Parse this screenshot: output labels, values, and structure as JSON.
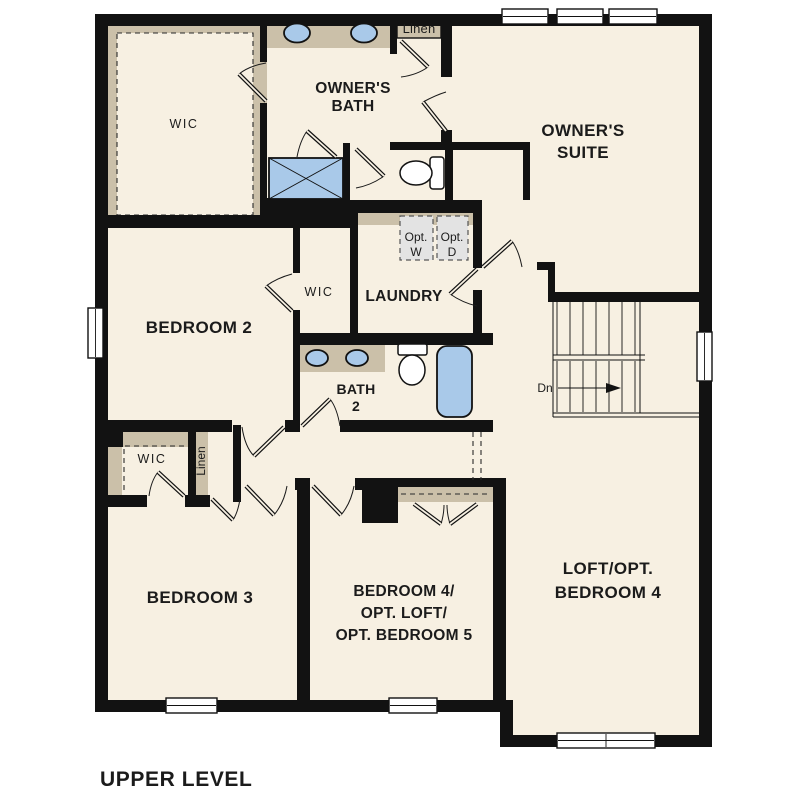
{
  "page": {
    "background": "#ffffff"
  },
  "colors": {
    "background": "#ffffff",
    "floor": "#f7f0e2",
    "wall": "#121212",
    "closet_tan": "#cbc0a9",
    "fixture_blue": "#a9c9e9",
    "appliance_gray": "#e3e3e3",
    "text": "#1b1b1b"
  },
  "floorplan": {
    "title": "UPPER LEVEL",
    "rooms": {
      "owners_suite": {
        "line1": "OWNER'S",
        "line2": "SUITE"
      },
      "owners_bath": {
        "line1": "OWNER'S",
        "line2": "BATH"
      },
      "bedroom2": {
        "label": "BEDROOM 2"
      },
      "bedroom3": {
        "label": "BEDROOM 3"
      },
      "bedroom4": {
        "line1": "BEDROOM 4/",
        "line2": "OPT. LOFT/",
        "line3": "OPT. BEDROOM 5"
      },
      "loft": {
        "line1": "LOFT/OPT.",
        "line2": "BEDROOM 4"
      },
      "laundry": {
        "label": "LAUNDRY",
        "opt_washer": {
          "line1": "Opt.",
          "line2": "W"
        },
        "opt_dryer": {
          "line1": "Opt.",
          "line2": "D"
        }
      },
      "bath2": {
        "line1": "BATH",
        "line2": "2"
      }
    },
    "closets": {
      "owners_wic": "WIC",
      "linen_upper": "Linen",
      "bedroom2_wic": "WIC",
      "bedroom3_wic": "WIC",
      "hall_linen": "Linen"
    },
    "stairs": {
      "down_label": "Dn"
    }
  }
}
